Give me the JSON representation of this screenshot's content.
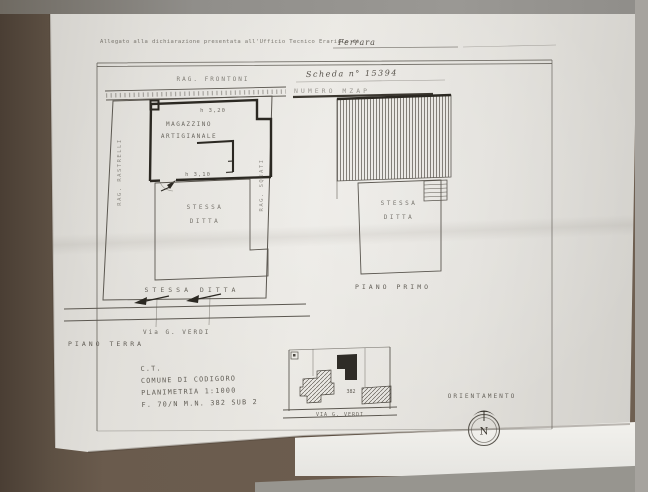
{
  "header": {
    "allegato_line": "Allegato alla dichiarazione presentata all'Ufficio Tecnico Erariale di",
    "place": "Ferrara",
    "scheda_label": "Scheda n° 15394",
    "scheda_sub": "NUMERO  MZAP"
  },
  "ground_floor": {
    "neighbor_top": "RAG. FRONTONI",
    "neighbor_left": "RAG. RASTRELLI",
    "neighbor_right": "RAG. SQUATI",
    "room_name_line1": "MAGAZZINO",
    "room_name_line2": "ARTIGIANALE",
    "height_top": "h 3,20",
    "height_mid": "h 3,10",
    "owner_mid_line1": "STESSA",
    "owner_mid_line2": "DITTA",
    "owner_bottom": "STESSA  DITTA",
    "street": "Via  G. VERDI",
    "caption": "PIANO  TERRA"
  },
  "first_floor": {
    "owner_line1": "STESSA",
    "owner_line2": "DITTA",
    "caption": "PIANO  PRIMO"
  },
  "cadastral_info": {
    "line1": "C.T.",
    "line2": "COMUNE DI CODIGORO",
    "line3": "PLANIMETRIA  1:1000",
    "line4": "F. 70/N   M.N. 382 SUB 2"
  },
  "location_map": {
    "parcel_number": "382",
    "street": "VIA G. VERDI"
  },
  "orientation": {
    "label": "ORIENTAMENTO",
    "north": "N"
  }
}
